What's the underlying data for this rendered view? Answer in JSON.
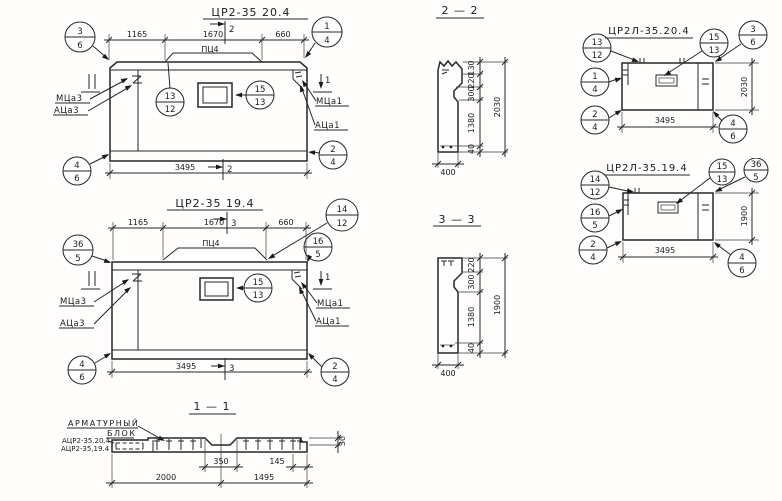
{
  "front20": {
    "title": "ЦР2-35 20.4",
    "plate": "ПЦ4",
    "cut": "2",
    "cut_side": "1",
    "dims": {
      "a": "1165",
      "b": "1670",
      "c": "660",
      "total": "3495"
    },
    "labels": {
      "m3": "МЦа3",
      "a3": "АЦа3",
      "m1": "МЦа1",
      "a1": "АЦа1"
    },
    "callouts": {
      "tl": {
        "t": "3",
        "b": "6"
      },
      "tr": {
        "t": "1",
        "b": "4"
      },
      "mid": {
        "t": "13",
        "b": "12"
      },
      "win": {
        "t": "15",
        "b": "13"
      },
      "bl": {
        "t": "4",
        "b": "6"
      },
      "br": {
        "t": "2",
        "b": "4"
      }
    }
  },
  "front19": {
    "title": "ЦР2-35 19.4",
    "plate": "ПЦ4",
    "cut": "3",
    "cut_side": "1",
    "dims": {
      "a": "1165",
      "b": "1670",
      "c": "660",
      "total": "3495"
    },
    "labels": {
      "m3": "МЦа3",
      "a3": "АЦа3",
      "m1": "МЦа1",
      "a1": "АЦа1"
    },
    "callouts": {
      "tl": {
        "t": "36",
        "b": "5"
      },
      "trf": {
        "t": "14",
        "b": "12"
      },
      "tr": {
        "t": "16",
        "b": "5"
      },
      "win": {
        "t": "15",
        "b": "13"
      },
      "bl": {
        "t": "4",
        "b": "6"
      },
      "br": {
        "t": "2",
        "b": "4"
      }
    }
  },
  "sec22": {
    "title": "2 — 2",
    "dims": {
      "d1": "130",
      "d2": "220",
      "d3": "300",
      "d4": "1380",
      "d5": "40",
      "total": "2030",
      "width": "400"
    }
  },
  "sec33": {
    "title": "3 — 3",
    "dims": {
      "d2": "220",
      "d3": "300",
      "d4": "1380",
      "d5": "40",
      "total": "1900",
      "width": "400"
    }
  },
  "side20": {
    "title": "ЦР2Л-35.20.4",
    "dims": {
      "total": "3495",
      "height": "2030"
    },
    "callouts": {
      "tl": {
        "t": "13",
        "b": "12"
      },
      "tm": {
        "t": "15",
        "b": "13"
      },
      "tr": {
        "t": "3",
        "b": "6"
      },
      "l": {
        "t": "1",
        "b": "4"
      },
      "bl": {
        "t": "2",
        "b": "4"
      },
      "br": {
        "t": "4",
        "b": "6"
      }
    }
  },
  "side19": {
    "title": "ЦР2Л-35.19.4",
    "dims": {
      "total": "3495",
      "height": "1900"
    },
    "callouts": {
      "tl": {
        "t": "14",
        "b": "12"
      },
      "tm": {
        "t": "15",
        "b": "13"
      },
      "tr": {
        "t": "36",
        "b": "5"
      },
      "l": {
        "t": "16",
        "b": "5"
      },
      "bl": {
        "t": "2",
        "b": "4"
      },
      "br": {
        "t": "4",
        "b": "6"
      }
    }
  },
  "sec11": {
    "title": "1 — 1",
    "block_line1": "АРМАТУРНЫЙ",
    "block_line2": "БЛОК",
    "ref1": "АЦР2-35.20.4",
    "ref2": "АЦР2-35,19.4",
    "dims": {
      "recess": "350",
      "edge": "145",
      "left": "2000",
      "right": "1495",
      "thk": "30"
    }
  }
}
